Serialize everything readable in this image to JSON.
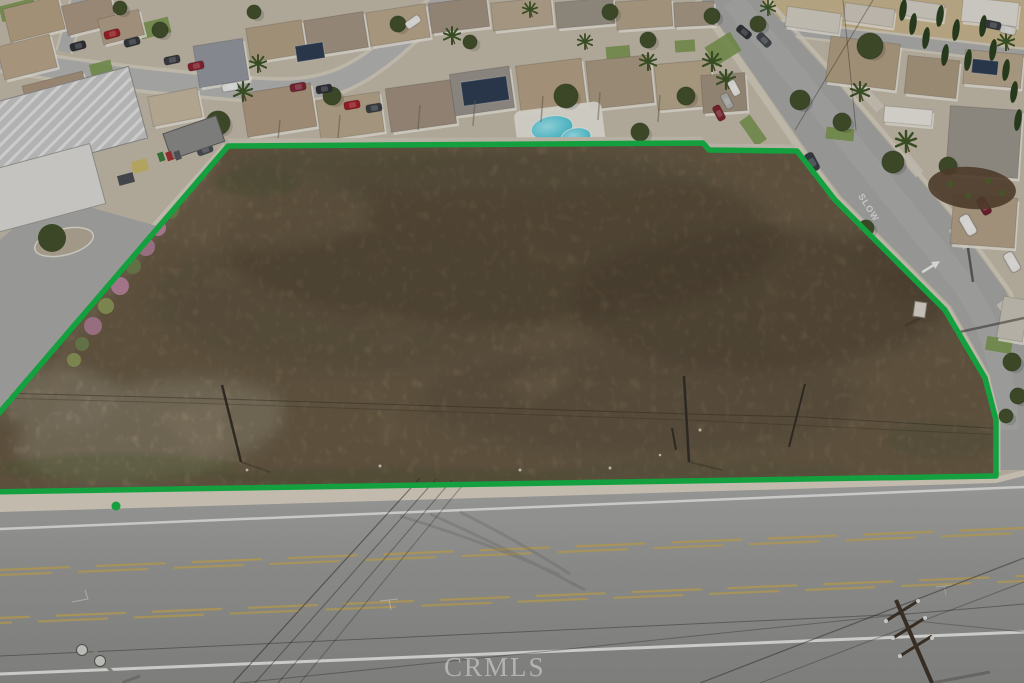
{
  "photo": {
    "alt": "Aerial drone photo of a vacant dirt land parcel outlined in green, bordered by suburban homes and streets"
  },
  "watermark": {
    "text": "CRMLS"
  },
  "road_markings": {
    "slow": "SLOW"
  },
  "colors": {
    "boundary-green": "#17b347",
    "dirt-base": "#a5906f",
    "dirt-dark": "#6f6048",
    "dirt-light": "#cdbc9d",
    "road-asphalt": "#9a9a98",
    "road-asphalt-light": "#ababa9",
    "sidewalk-concrete": "#d8d1c2",
    "roof-tan": "#b3a086",
    "roof-gray": "#9b958b",
    "tree-green": "#42502c",
    "lawn-green": "#7a9750",
    "pool-water": "#49c4d6",
    "lane-yellow": "#c2a85c",
    "marking-white": "#ebebe9",
    "watermark-white": "#ffffff"
  }
}
